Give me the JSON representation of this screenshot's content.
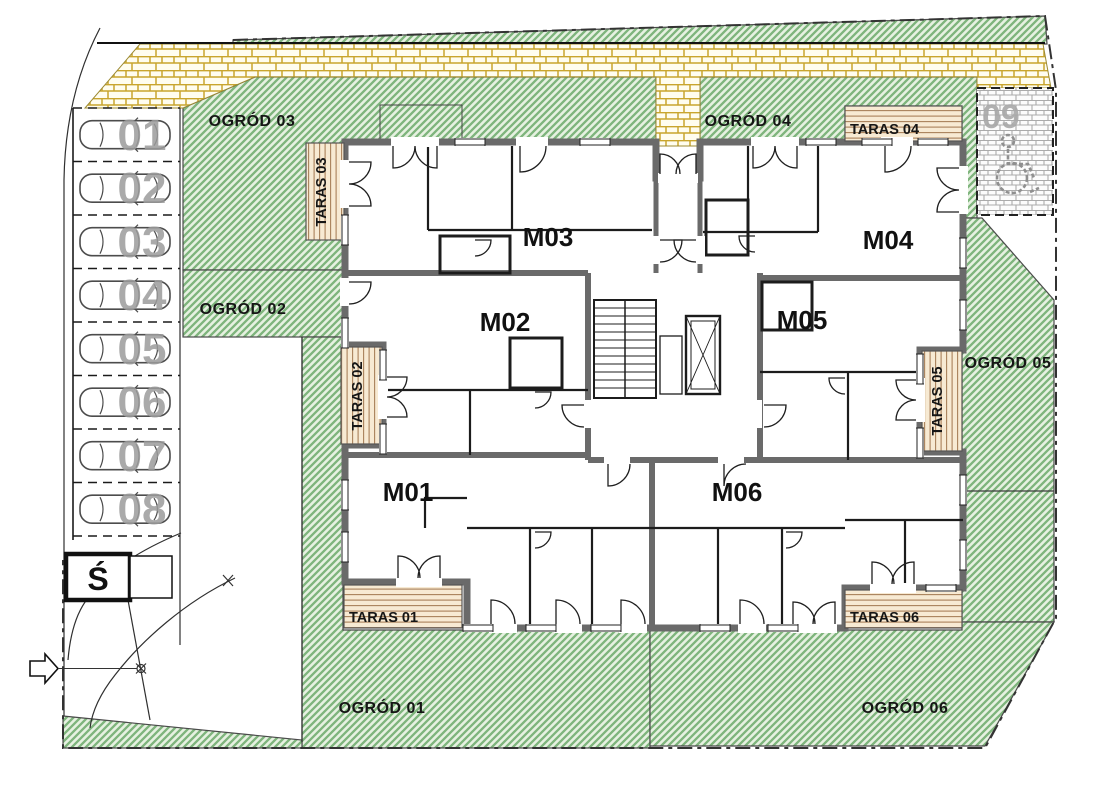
{
  "site_plan": {
    "apartments": [
      {
        "id": "m01",
        "label": "M01"
      },
      {
        "id": "m02",
        "label": "M02"
      },
      {
        "id": "m03",
        "label": "M03"
      },
      {
        "id": "m04",
        "label": "M04"
      },
      {
        "id": "m05",
        "label": "M05"
      },
      {
        "id": "m06",
        "label": "M06"
      }
    ],
    "gardens": [
      {
        "id": "ogrod-01",
        "label": "OGRÓD 01"
      },
      {
        "id": "ogrod-02",
        "label": "OGRÓD 02"
      },
      {
        "id": "ogrod-03",
        "label": "OGRÓD 03"
      },
      {
        "id": "ogrod-04",
        "label": "OGRÓD 04"
      },
      {
        "id": "ogrod-05",
        "label": "OGRÓD 05"
      },
      {
        "id": "ogrod-06",
        "label": "OGRÓD 06"
      }
    ],
    "terraces": [
      {
        "id": "taras-01",
        "label": "TARAS 01"
      },
      {
        "id": "taras-02",
        "label": "TARAS 02"
      },
      {
        "id": "taras-03",
        "label": "TARAS 03"
      },
      {
        "id": "taras-04",
        "label": "TARAS 04"
      },
      {
        "id": "taras-05",
        "label": "TARAS 05"
      },
      {
        "id": "taras-06",
        "label": "TARAS 06"
      }
    ],
    "parking": {
      "spaces": [
        {
          "label": "01"
        },
        {
          "label": "02"
        },
        {
          "label": "03"
        },
        {
          "label": "04"
        },
        {
          "label": "05"
        },
        {
          "label": "06"
        },
        {
          "label": "07"
        },
        {
          "label": "08"
        }
      ],
      "accessible_space": {
        "label": "09"
      },
      "waste_shed_label": "Ś"
    },
    "colors": {
      "garden_fill": "#e6f1e1",
      "garden_hatch": "#7eb47c",
      "paving_joint": "#c9a52e",
      "deck_plank": "#a8805a",
      "wall_grey": "#6a6a6a",
      "parking_number_grey": "#9c9c9c",
      "accessible_number_grey": "#a8a8a8"
    }
  }
}
